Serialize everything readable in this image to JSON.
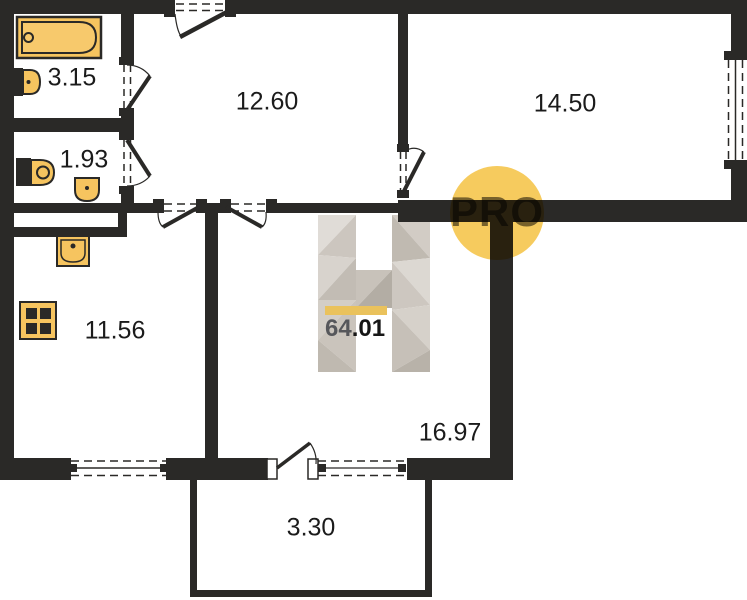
{
  "plan": {
    "badge_label": "PRO",
    "total_area": {
      "whole": "64",
      "fraction": ".01"
    },
    "rooms": [
      {
        "name": "bathroom",
        "area": "3.15"
      },
      {
        "name": "wc",
        "area": "1.93"
      },
      {
        "name": "hallway",
        "area": "12.60"
      },
      {
        "name": "room-right",
        "area": "14.50"
      },
      {
        "name": "kitchen",
        "area": "11.56"
      },
      {
        "name": "living-room",
        "area": "16.97"
      },
      {
        "name": "balcony",
        "area": "3.30"
      }
    ],
    "icons": [
      "bathtub-icon",
      "washbasin-icon",
      "toilet-icon",
      "wc-sink-icon",
      "kitchen-sink-icon",
      "stove-icon"
    ],
    "colors": {
      "wall": "#2a2927",
      "fixture_fill": "#f6c45f",
      "badge_fill": "#f6cb5e",
      "accent_bar": "#eac25c",
      "watermark_light": "#ddd9d3",
      "watermark_dark": "#b5afa6"
    }
  }
}
